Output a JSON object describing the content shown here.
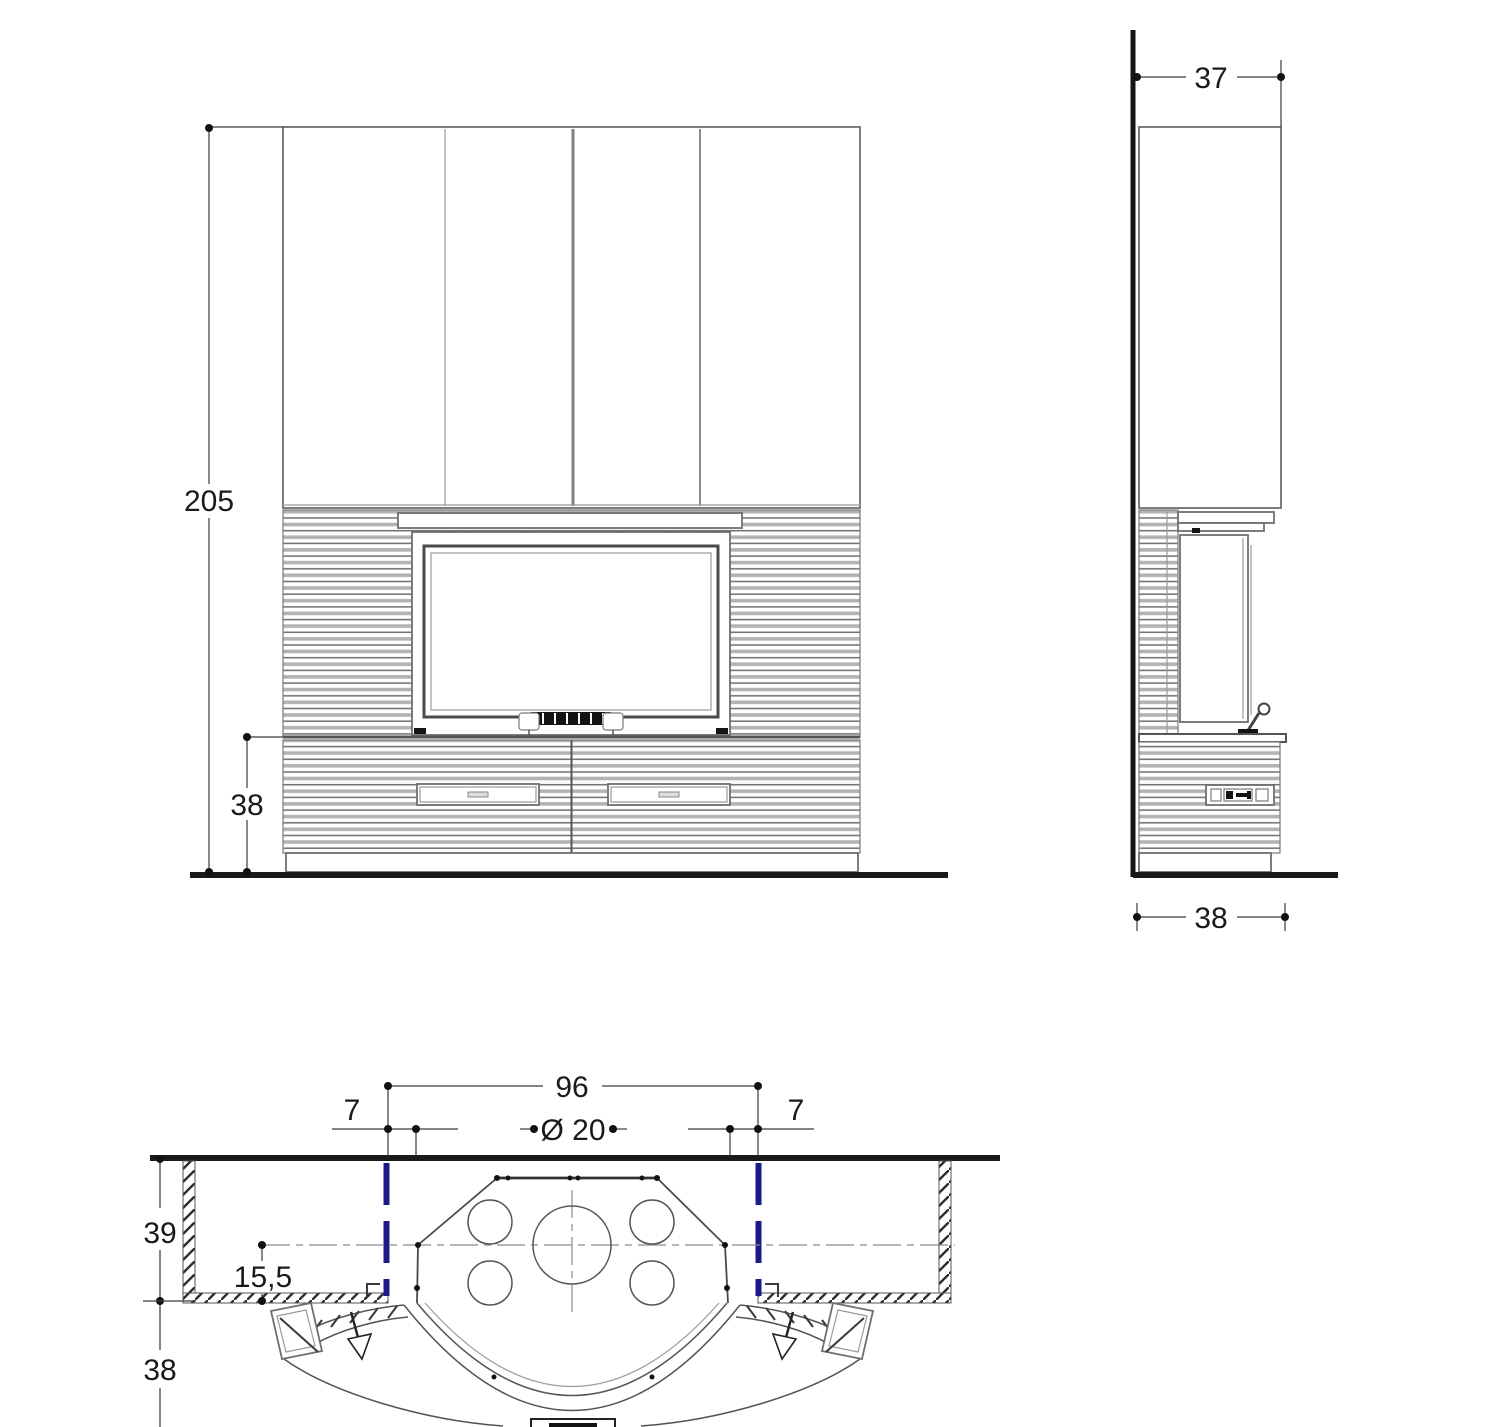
{
  "drawing_type": "fireplace installation technical drawing, three orthographic views",
  "colors": {
    "background": "#ffffff",
    "line": "#6f6f6f",
    "dark_line": "#1a1a1a",
    "flue_marker_blue": "#1b1b86",
    "text": "#1a1a1a"
  },
  "dimensions": {
    "front": {
      "height": "205",
      "hearth_height": "38"
    },
    "side": {
      "top_depth": "37",
      "base_depth": "38"
    },
    "plan": {
      "opening_width": "96",
      "left_inset": "7",
      "flue_diameter": "Ø 20",
      "right_inset": "7",
      "enclosure_depth": "39",
      "flue_center_offset": "15,5",
      "hearth_depth": "38"
    }
  }
}
